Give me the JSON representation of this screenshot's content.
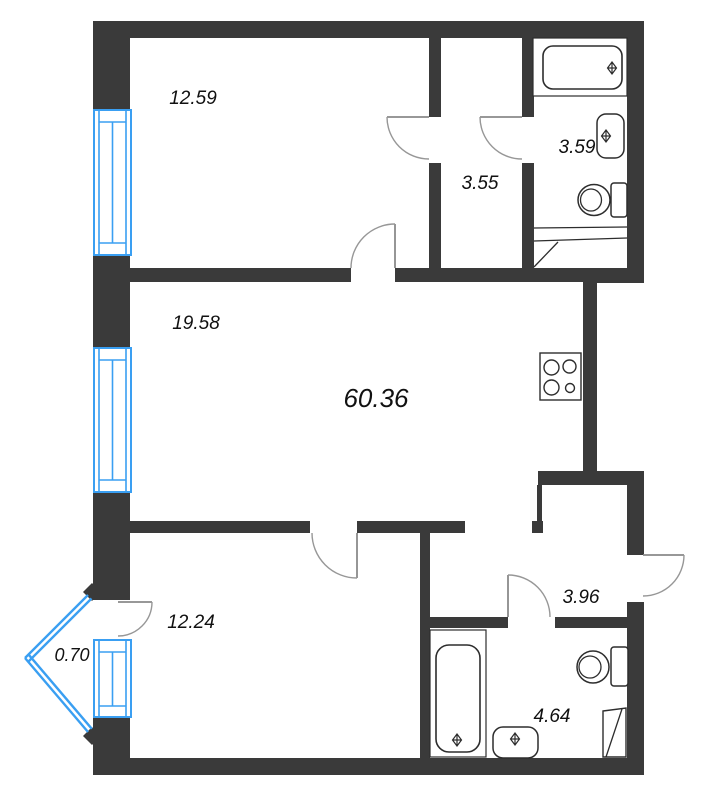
{
  "plan": {
    "type": "apartment-floor-plan",
    "total_area": "60.36",
    "rooms": [
      {
        "id": "room-top-left",
        "area": "12.59"
      },
      {
        "id": "hallway-top",
        "area": "3.55"
      },
      {
        "id": "bathroom-top",
        "area": "3.59"
      },
      {
        "id": "living-room",
        "area": "19.58"
      },
      {
        "id": "room-bottom-left",
        "area": "12.24"
      },
      {
        "id": "balcony",
        "area": "0.70"
      },
      {
        "id": "hallway-bottom",
        "area": "3.96"
      },
      {
        "id": "bathroom-bottom",
        "area": "4.64"
      }
    ],
    "fixtures": [
      "bathtub",
      "sink",
      "toilet",
      "stove",
      "vent-shaft",
      "window",
      "door",
      "balcony-glazing"
    ],
    "colors": {
      "wall": "#3a3a3a",
      "window": "#3a9ff2",
      "door_arc": "#979797",
      "fixture_outline": "#2d2d2d",
      "label_text": "#111111",
      "background": "#ffffff"
    }
  }
}
